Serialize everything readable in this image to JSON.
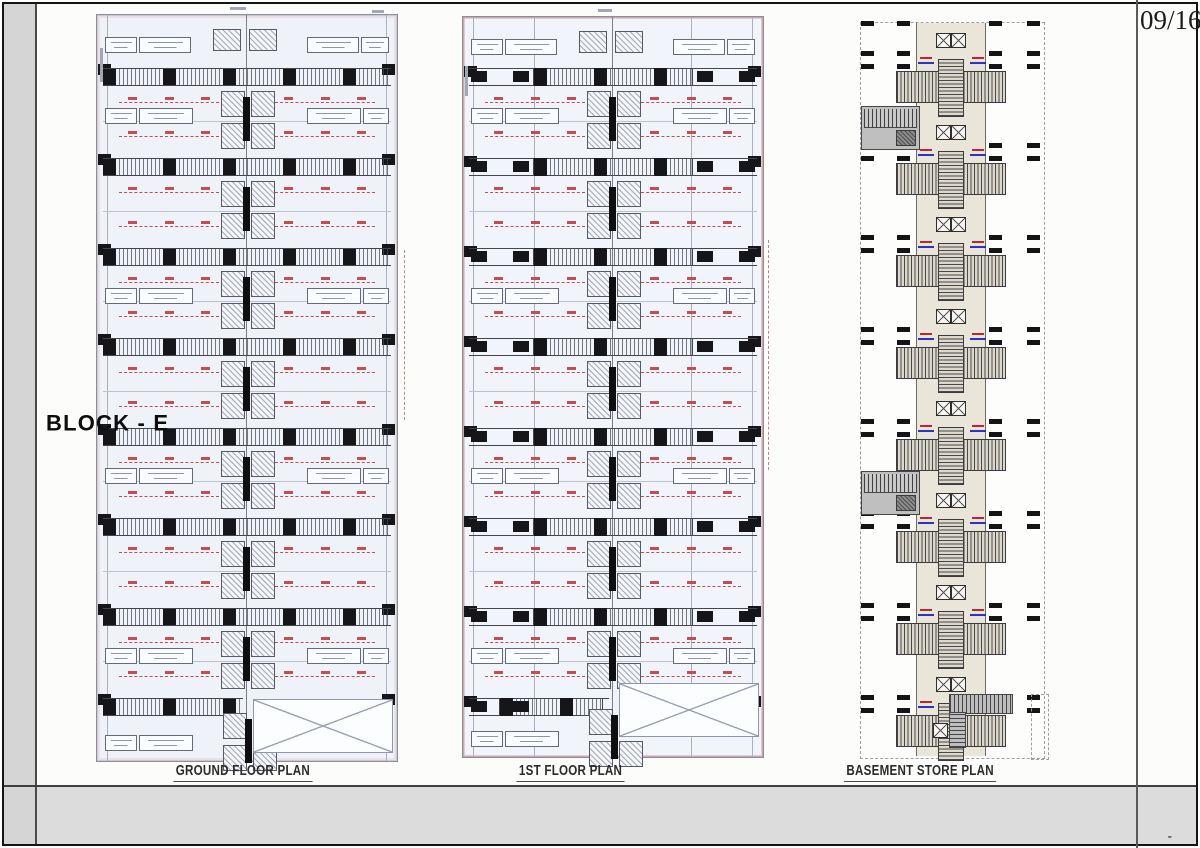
{
  "sheet": {
    "type": "scanned architectural drawing sheet",
    "footer": {
      "title": "BLOCK - E",
      "page_number": "09/16",
      "tick": "-"
    }
  },
  "plans": [
    {
      "id": "ground-floor",
      "label": "GROUND FLOOR PLAN",
      "bands": 8,
      "style": "full-width-hatched-walls"
    },
    {
      "id": "first-floor",
      "label": "1ST FLOOR PLAN",
      "bands": 8,
      "style": "center-hatched-walls"
    },
    {
      "id": "basement-store",
      "label": "BASEMENT STORE PLAN",
      "store_modules": 8,
      "stair_wings": 2
    }
  ],
  "colors": {
    "dimension_red": "#c05050",
    "store_label_red": "#c3242e",
    "store_label_blue": "#2a35c2",
    "store_strip_beige": "#e9e5d8",
    "footer_gray": "#dcdcdc"
  }
}
